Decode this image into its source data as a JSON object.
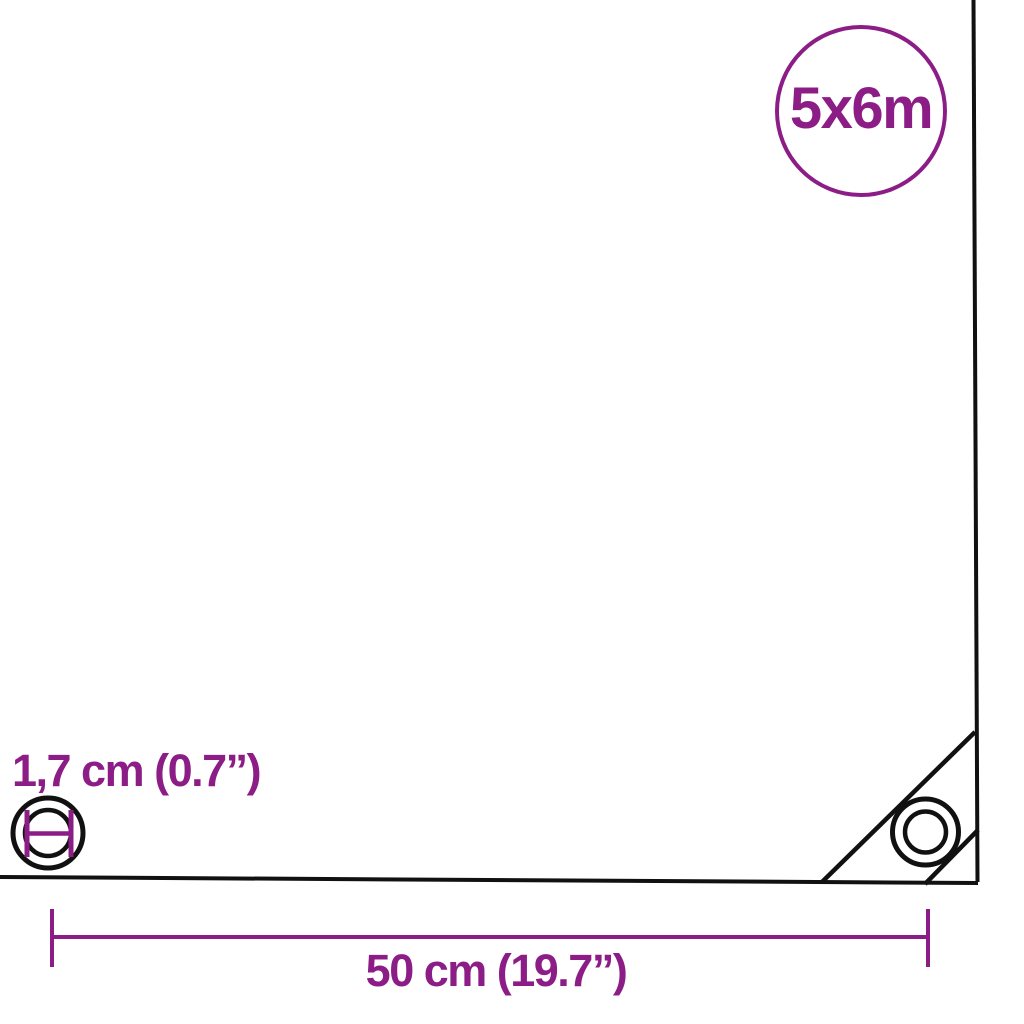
{
  "colors": {
    "accent": "#8c1d86",
    "line": "#111111",
    "background": "#ffffff"
  },
  "size_badge": {
    "label": "5x6m"
  },
  "measurements": {
    "eyelet_diameter_label": "1,7 cm (0.7”)",
    "eyelet_spacing_label": "50 cm (19.7”)"
  },
  "icons": {
    "size_badge": "circle-badge",
    "tarp_outline": "tarp-sheet-outline",
    "corner_seam": "corner-reinforcement-seam",
    "eyelet_right": "eyelet-rings-icon",
    "eyelet_left": "eyelet-rings-icon",
    "eyelet_diameter_marker": "diameter-h-marker-icon",
    "dimension_line": "dimension-line-with-end-ticks"
  }
}
